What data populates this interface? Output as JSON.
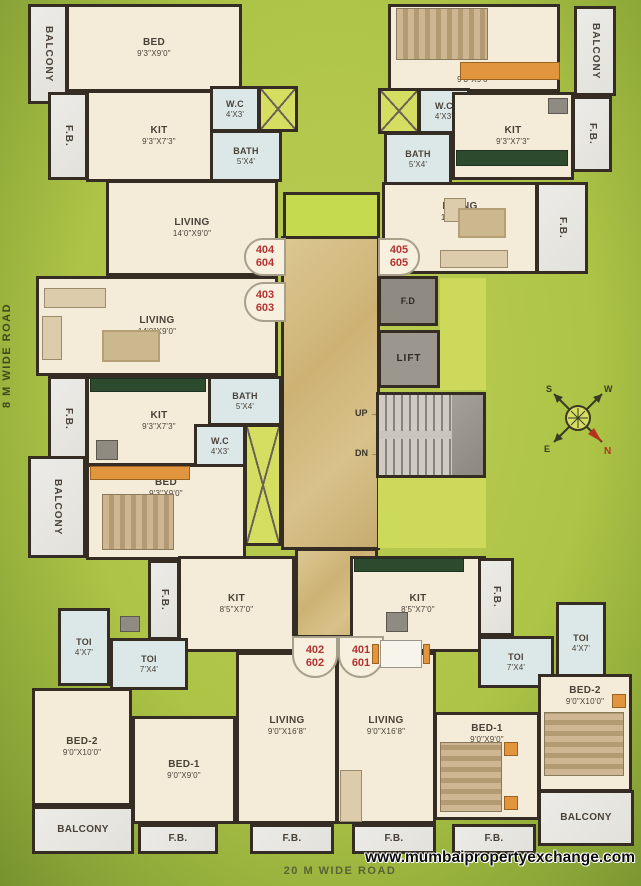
{
  "roads": {
    "left": "8 M WIDE ROAD",
    "bottom": "20 M WIDE ROAD"
  },
  "watermark": "www.mumbaipropertyexchange.com",
  "compass": {
    "n": "N",
    "s": "S",
    "e": "E",
    "w": "W"
  },
  "core": {
    "fd": "F.D",
    "lift": "LIFT",
    "up": "UP",
    "dn": "DN"
  },
  "units": {
    "u404": {
      "top": "404",
      "bottom": "604"
    },
    "u403": {
      "top": "403",
      "bottom": "603"
    },
    "u405": {
      "top": "405",
      "bottom": "605"
    },
    "u402": {
      "top": "402",
      "bottom": "602"
    },
    "u401": {
      "top": "401",
      "bottom": "601"
    }
  },
  "rooms": {
    "balcony_tl": {
      "name": "BALCONY"
    },
    "bed_tl": {
      "name": "BED",
      "dim": "9'3\"X9'0\""
    },
    "fb_tl": {
      "name": "F.B."
    },
    "kit_tl": {
      "name": "KIT",
      "dim": "9'3\"X7'3\""
    },
    "wc_tl": {
      "name": "W.C",
      "dim": "4'X3'"
    },
    "bath_tl": {
      "name": "BATH",
      "dim": "5'X4'"
    },
    "living_tl": {
      "name": "LIVING",
      "dim": "14'0\"X9'0\""
    },
    "living_ml": {
      "name": "LIVING",
      "dim": "14'0\"X9'0\""
    },
    "fb_ml": {
      "name": "F.B."
    },
    "kit_ml": {
      "name": "KIT",
      "dim": "9'3\"X7'3\""
    },
    "bath_ml": {
      "name": "BATH",
      "dim": "5'X4'"
    },
    "wc_ml": {
      "name": "W.C",
      "dim": "4'X3'"
    },
    "bed_ml": {
      "name": "BED",
      "dim": "9'3\"X9'0\""
    },
    "balcony_ml": {
      "name": "BALCONY"
    },
    "bed_tr": {
      "name": "BED",
      "dim": "9'3\"X9'0\""
    },
    "balcony_tr": {
      "name": "BALCONY"
    },
    "wc_tr": {
      "name": "W.C",
      "dim": "4'X3'"
    },
    "kit_tr": {
      "name": "KIT",
      "dim": "9'3\"X7'3\""
    },
    "bath_tr": {
      "name": "BATH",
      "dim": "5'X4'"
    },
    "fb_tr": {
      "name": "F.B."
    },
    "living_tr": {
      "name": "LIVING",
      "dim": "14'0\"X9'0\""
    },
    "fb_tr2": {
      "name": "F.B."
    },
    "kit_bl": {
      "name": "KIT",
      "dim": "8'5\"X7'0\""
    },
    "fb_bl": {
      "name": "F.B."
    },
    "toi_a_bl": {
      "name": "TOI",
      "dim": "4'X7'"
    },
    "toi_b_bl": {
      "name": "TOI",
      "dim": "7'X4'"
    },
    "bed2_bl": {
      "name": "BED-2",
      "dim": "9'0\"X10'0\""
    },
    "bed1_bl": {
      "name": "BED-1",
      "dim": "9'0\"X9'0\""
    },
    "living_bl": {
      "name": "LIVING",
      "dim": "9'0\"X16'8\""
    },
    "balcony_bl": {
      "name": "BALCONY"
    },
    "fb_bl2": {
      "name": "F.B."
    },
    "fb_bl3": {
      "name": "F.B."
    },
    "kit_br": {
      "name": "KIT",
      "dim": "8'5\"X7'0\""
    },
    "fb_br": {
      "name": "F.B."
    },
    "toi_b_br": {
      "name": "TOI",
      "dim": "7'X4'"
    },
    "toi_a_br": {
      "name": "TOI",
      "dim": "4'X7'"
    },
    "bed2_br": {
      "name": "BED-2",
      "dim": "9'0\"X10'0\""
    },
    "bed1_br": {
      "name": "BED-1",
      "dim": "9'0\"X9'0\""
    },
    "living_br": {
      "name": "LIVING",
      "dim": "9'0\"X16'8\""
    },
    "balcony_br": {
      "name": "BALCONY"
    },
    "fb_br2": {
      "name": "F.B."
    },
    "fb_br3": {
      "name": "F.B."
    }
  }
}
